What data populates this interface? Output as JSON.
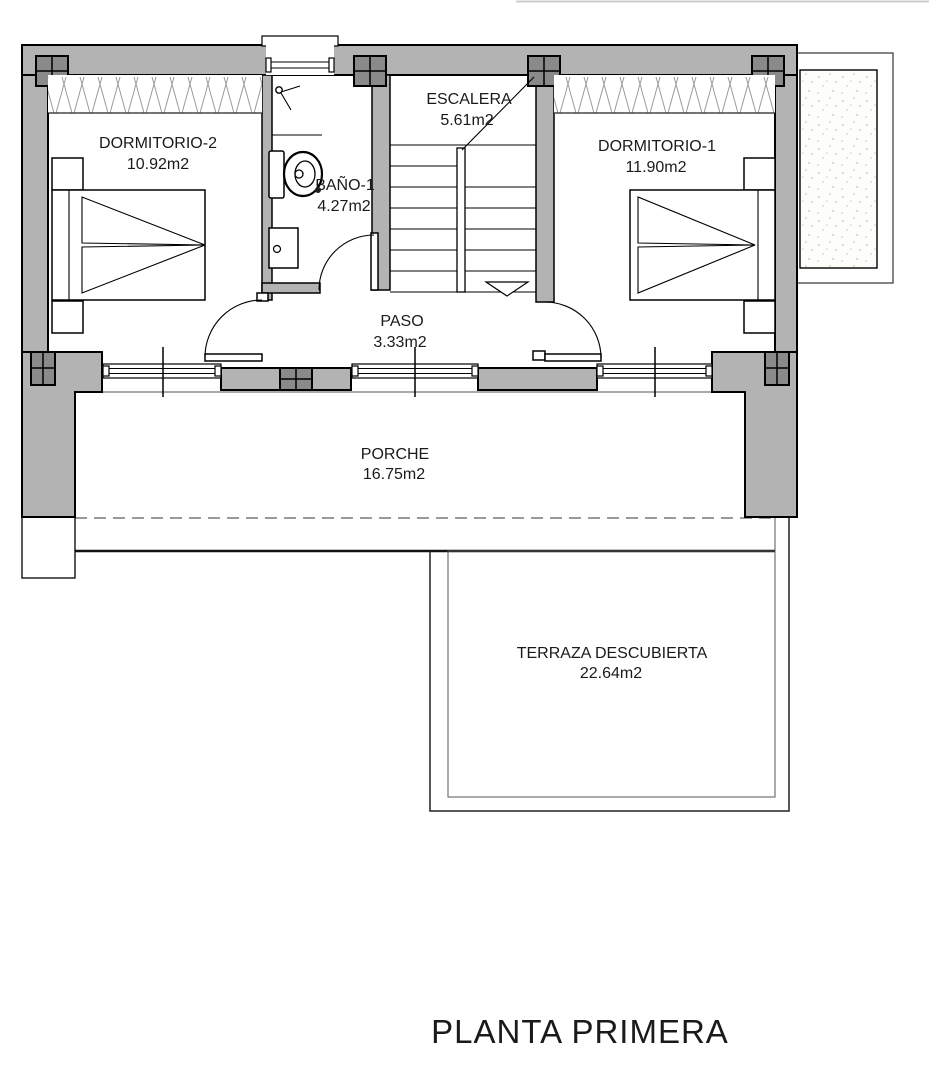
{
  "title": "PLANTA PRIMERA",
  "colors": {
    "wall": "#b3b3b3",
    "pilaster": "#8a8a8a",
    "deck_bg": "#f9f9ef",
    "deck_line": "#c9c9b3",
    "hatch_line": "#9a9a9a",
    "stipple_dot": "#cccccc",
    "line": "#000000"
  },
  "rooms": [
    {
      "id": "dormitorio-2",
      "label": "DORMITORIO-2",
      "area": "10.92m2"
    },
    {
      "id": "bano-1",
      "label": "BAÑO-1",
      "area": "4.27m2"
    },
    {
      "id": "escalera",
      "label": "ESCALERA",
      "area": "5.61m2"
    },
    {
      "id": "dormitorio-1",
      "label": "DORMITORIO-1",
      "area": "11.90m2"
    },
    {
      "id": "paso",
      "label": "PASO",
      "area": "3.33m2"
    },
    {
      "id": "porche",
      "label": "PORCHE",
      "area": "16.75m2"
    },
    {
      "id": "terraza",
      "label": "TERRAZA DESCUBIERTA",
      "area": "22.64m2"
    }
  ]
}
